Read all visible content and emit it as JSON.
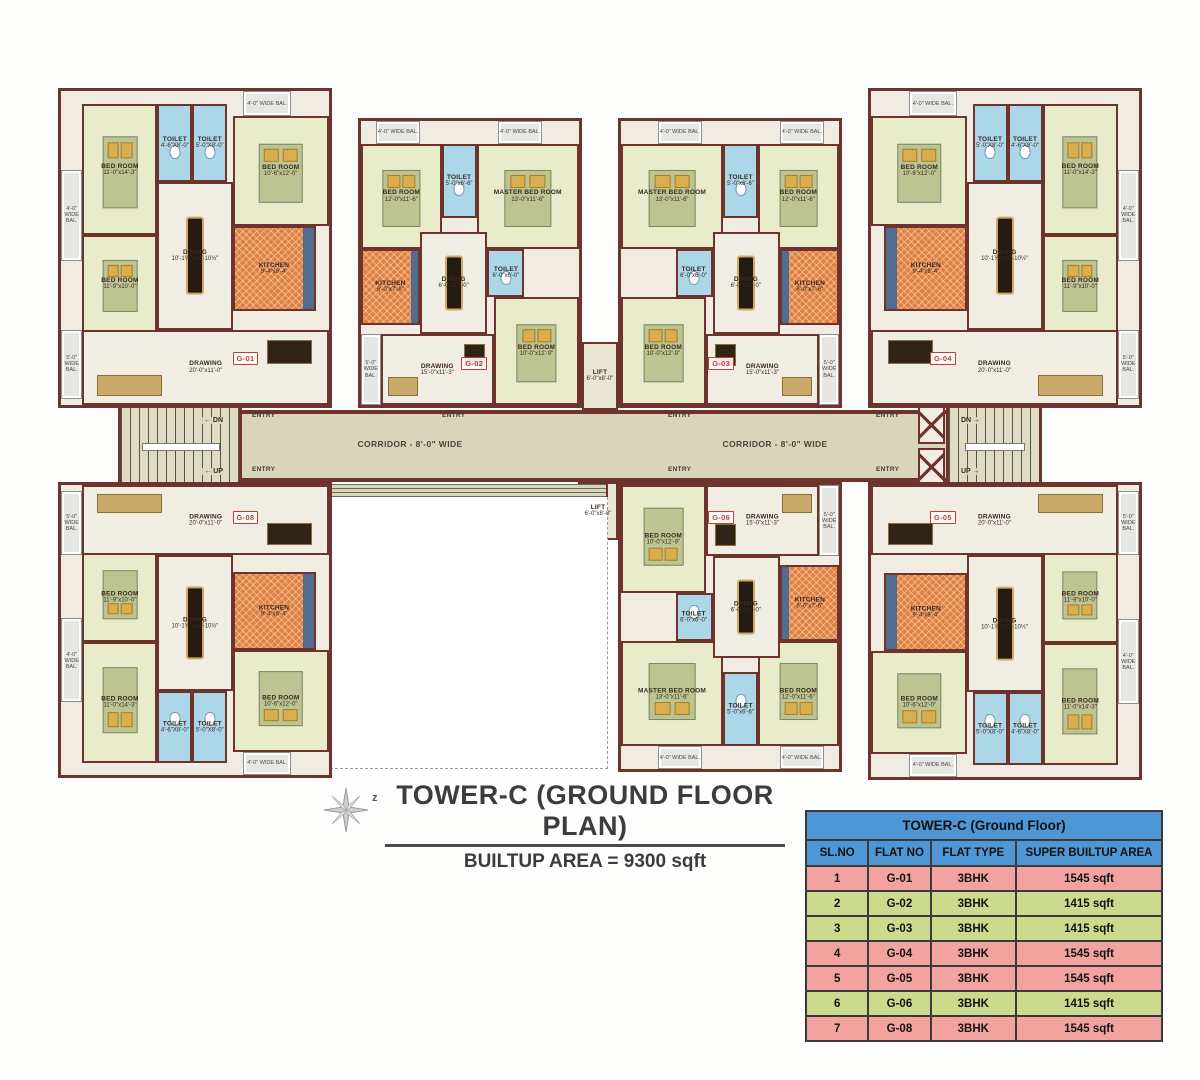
{
  "title": {
    "main": "TOWER-C (GROUND FLOOR PLAN)",
    "sub": "BUILTUP AREA = 9300 sqft",
    "compass_letter": "z"
  },
  "corridor": {
    "label": "CORRIDOR - 8'-0\" WIDE",
    "entry": "ENTRY",
    "dn_left": "← DN",
    "up_left": "← UP",
    "dn_right": "DN →",
    "up_right": "UP →",
    "lift_name": "LIFT",
    "lift_dims": "6'-0\"x8'-0\""
  },
  "room_templates": {
    "A": [
      {
        "cls": "balcony",
        "name": "",
        "dims": "4'-0\" WIDE BAL.",
        "x": 0,
        "y": 25,
        "w": 8,
        "h": 29
      },
      {
        "cls": "bedroom",
        "name": "BED ROOM",
        "dims": "11'-0\"x14'-3\"",
        "x": 8,
        "y": 4,
        "w": 28,
        "h": 42
      },
      {
        "cls": "toilet",
        "name": "TOILET",
        "dims": "4'-6\"X8'-0\"",
        "x": 36,
        "y": 4,
        "w": 13,
        "h": 25
      },
      {
        "cls": "toilet",
        "name": "TOILET",
        "dims": "5'-0\"X8'-0\"",
        "x": 49,
        "y": 4,
        "w": 13,
        "h": 25
      },
      {
        "cls": "balcony",
        "name": "",
        "dims": "4'-0\" WIDE BAL.",
        "x": 68,
        "y": 0,
        "w": 18,
        "h": 8
      },
      {
        "cls": "bedroom",
        "name": "BED ROOM",
        "dims": "10'-6\"x12'-0\"",
        "x": 64,
        "y": 8,
        "w": 36,
        "h": 35
      },
      {
        "cls": "bedroom",
        "name": "BED ROOM",
        "dims": "11'-9\"x10'-0\"",
        "x": 8,
        "y": 46,
        "w": 28,
        "h": 31
      },
      {
        "cls": "dining",
        "name": "DINING",
        "dims": "10'-1½\"x12'-10½\"",
        "x": 36,
        "y": 29,
        "w": 28,
        "h": 47
      },
      {
        "cls": "kitchen",
        "name": "KITCHEN",
        "dims": "9'-4\"x8'-4\"",
        "x": 64,
        "y": 43,
        "w": 31,
        "h": 27
      },
      {
        "cls": "balcony",
        "name": "",
        "dims": "5'-0\" WIDE BAL.",
        "x": 0,
        "y": 76,
        "w": 8,
        "h": 22
      },
      {
        "cls": "drawing",
        "name": "DRAWING",
        "dims": "20'-0\"x11'-0\"",
        "x": 8,
        "y": 76,
        "w": 92,
        "h": 24
      }
    ],
    "B": [
      {
        "cls": "balcony",
        "name": "",
        "dims": "4'-0\" WIDE BAL.",
        "x": 7,
        "y": 0,
        "w": 20,
        "h": 8
      },
      {
        "cls": "balcony",
        "name": "",
        "dims": "4'-0\" WIDE BAL.",
        "x": 63,
        "y": 0,
        "w": 20,
        "h": 8
      },
      {
        "cls": "bedroom",
        "name": "BED ROOM",
        "dims": "12'-0\"x11'-6\"",
        "x": 0,
        "y": 8,
        "w": 37,
        "h": 37
      },
      {
        "cls": "toilet",
        "name": "TOILET",
        "dims": "5'-0\"x6'-6\"",
        "x": 37,
        "y": 8,
        "w": 16,
        "h": 26
      },
      {
        "cls": "bedroom",
        "name": "MASTER BED ROOM",
        "dims": "13'-0\"x11'-6\"",
        "x": 53,
        "y": 8,
        "w": 47,
        "h": 37
      },
      {
        "cls": "kitchen",
        "name": "KITCHEN",
        "dims": "6'-0\"x7'-6\"",
        "x": 0,
        "y": 45,
        "w": 27,
        "h": 27
      },
      {
        "cls": "dining",
        "name": "DINING",
        "dims": "6'-0\"x10'-0\"",
        "x": 27,
        "y": 39,
        "w": 31,
        "h": 36
      },
      {
        "cls": "toilet",
        "name": "TOILET",
        "dims": "6'-0\"x6'-0\"",
        "x": 58,
        "y": 45,
        "w": 17,
        "h": 17
      },
      {
        "cls": "bedroom",
        "name": "BED ROOM",
        "dims": "10'-0\"x12'-9\"",
        "x": 61,
        "y": 62,
        "w": 39,
        "h": 38
      },
      {
        "cls": "balcony",
        "name": "",
        "dims": "5'-0\" WIDE BAL.",
        "x": 0,
        "y": 75,
        "w": 9,
        "h": 25
      },
      {
        "cls": "drawing",
        "name": "DRAWING",
        "dims": "15'-0\"x11'-3\"",
        "x": 9,
        "y": 75,
        "w": 52,
        "h": 25
      }
    ]
  },
  "units": [
    {
      "label": "G-01",
      "type": "A",
      "x": 58,
      "y": 88,
      "w": 274,
      "h": 320,
      "mx": false,
      "my": false
    },
    {
      "label": "G-02",
      "type": "B",
      "x": 358,
      "y": 118,
      "w": 224,
      "h": 290,
      "mx": false,
      "my": false
    },
    {
      "label": "G-03",
      "type": "B",
      "x": 618,
      "y": 118,
      "w": 224,
      "h": 290,
      "mx": true,
      "my": false
    },
    {
      "label": "G-04",
      "type": "A",
      "x": 868,
      "y": 88,
      "w": 274,
      "h": 320,
      "mx": true,
      "my": false
    },
    {
      "label": "G-08",
      "type": "A",
      "x": 58,
      "y": 482,
      "w": 274,
      "h": 296,
      "mx": false,
      "my": true
    },
    {
      "label": "G-06",
      "type": "B",
      "x": 618,
      "y": 482,
      "w": 224,
      "h": 290,
      "mx": true,
      "my": true
    },
    {
      "label": "G-05",
      "type": "A",
      "x": 868,
      "y": 482,
      "w": 274,
      "h": 298,
      "mx": true,
      "my": true
    }
  ],
  "table": {
    "title": "TOWER-C (Ground Floor)",
    "columns": [
      "SL.NO",
      "FLAT NO",
      "FLAT TYPE",
      "SUPER BUILTUP AREA"
    ],
    "rows": [
      [
        "1",
        "G-01",
        "3BHK",
        "1545 sqft"
      ],
      [
        "2",
        "G-02",
        "3BHK",
        "1415 sqft"
      ],
      [
        "3",
        "G-03",
        "3BHK",
        "1415 sqft"
      ],
      [
        "4",
        "G-04",
        "3BHK",
        "1545 sqft"
      ],
      [
        "5",
        "G-05",
        "3BHK",
        "1545 sqft"
      ],
      [
        "6",
        "G-06",
        "3BHK",
        "1415 sqft"
      ],
      [
        "7",
        "G-08",
        "3BHK",
        "1545 sqft"
      ]
    ],
    "row_tints": [
      "pink",
      "green",
      "green",
      "pink",
      "pink",
      "green",
      "pink"
    ]
  }
}
